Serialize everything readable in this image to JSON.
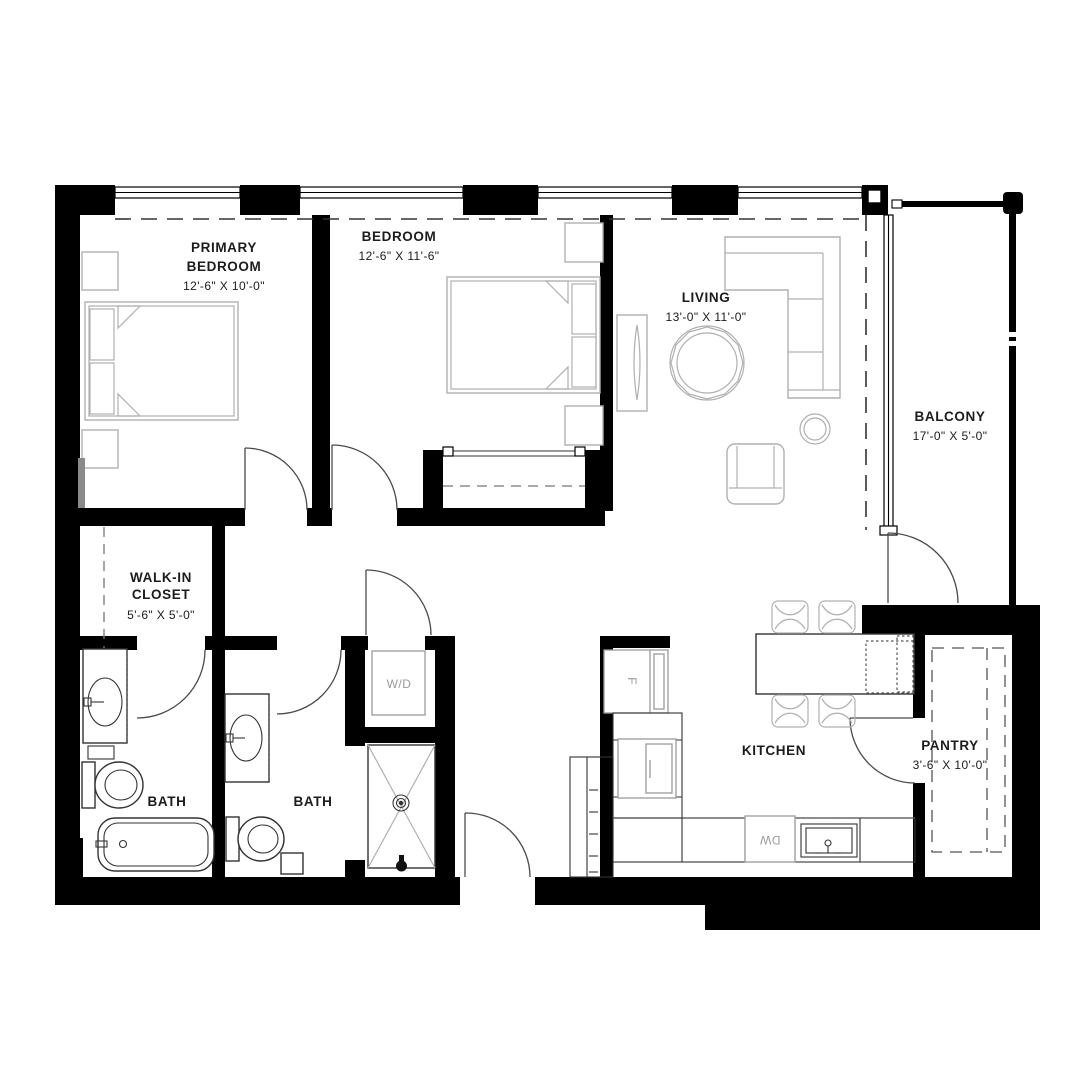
{
  "plan": {
    "colors": {
      "background": "#ffffff",
      "walls": "#000000",
      "furniture": "#b0b0b0",
      "fixtures": "#333333",
      "labels": "#1c1c1c",
      "appliance_labels": "#9a9a9a"
    },
    "rooms": [
      {
        "id": "primary-bedroom",
        "name_lines": [
          "PRIMARY",
          "BEDROOM"
        ],
        "dims": "12'-6\" X 10'-0\""
      },
      {
        "id": "bedroom",
        "name_lines": [
          "BEDROOM"
        ],
        "dims": "12'-6\" X 11'-6\""
      },
      {
        "id": "living",
        "name_lines": [
          "LIVING"
        ],
        "dims": "13'-0\" X 11'-0\""
      },
      {
        "id": "balcony",
        "name_lines": [
          "BALCONY"
        ],
        "dims": "17'-0\" X 5'-0\""
      },
      {
        "id": "walk-in-closet",
        "name_lines": [
          "WALK-IN",
          "CLOSET"
        ],
        "dims": "5'-6\" X 5'-0\""
      },
      {
        "id": "bath-1",
        "name_lines": [
          "BATH"
        ],
        "dims": ""
      },
      {
        "id": "bath-2",
        "name_lines": [
          "BATH"
        ],
        "dims": ""
      },
      {
        "id": "kitchen",
        "name_lines": [
          "KITCHEN"
        ],
        "dims": ""
      },
      {
        "id": "pantry",
        "name_lines": [
          "PANTRY"
        ],
        "dims": "3'-6\" X 10'-0\""
      }
    ],
    "appliances": [
      {
        "id": "washer-dryer",
        "label": "W/D"
      },
      {
        "id": "refrigerator",
        "label": "F"
      },
      {
        "id": "dishwasher",
        "label": "DW"
      }
    ]
  }
}
